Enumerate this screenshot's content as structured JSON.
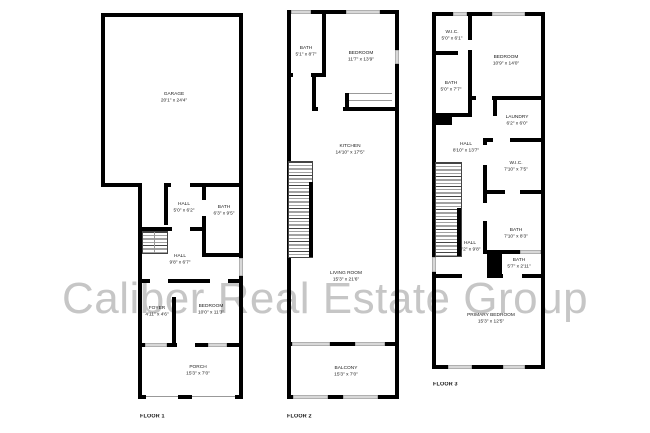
{
  "watermark": {
    "text": "Caliber Real Estate Group"
  },
  "colors": {
    "wall": "#000000",
    "window": "#d8d8d8",
    "watermark": "#c6c6c6"
  },
  "floors": [
    {
      "label": "FLOOR 1",
      "rooms": [
        {
          "name": "GARAGE",
          "dims": "20'1\" x 24'4\""
        },
        {
          "name": "HALL",
          "dims": "5'0\" x 6'2\""
        },
        {
          "name": "BATH",
          "dims": "6'3\" x 9'5\""
        },
        {
          "name": "HALL",
          "dims": "9'8\" x 6'7\""
        },
        {
          "name": "FOYER",
          "dims": "4'11\" x 4'6\""
        },
        {
          "name": "BEDROOM",
          "dims": "10'0\" x 11'3\""
        },
        {
          "name": "PORCH",
          "dims": "15'3\" x 7'0\""
        }
      ]
    },
    {
      "label": "FLOOR 2",
      "rooms": [
        {
          "name": "BATH",
          "dims": "5'1\" x 8'7\""
        },
        {
          "name": "BEDROOM",
          "dims": "11'7\" x 13'9\""
        },
        {
          "name": "KITCHEN",
          "dims": "14'10\" x 17'5\""
        },
        {
          "name": "LIVING ROOM",
          "dims": "15'3\" x 21'6\""
        },
        {
          "name": "BALCONY",
          "dims": "15'3\" x 7'0\""
        }
      ]
    },
    {
      "label": "FLOOR 3",
      "rooms": [
        {
          "name": "W.I.C.",
          "dims": "5'0\" x 6'1\""
        },
        {
          "name": "BEDROOM",
          "dims": "10'9\" x 14'0\""
        },
        {
          "name": "BATH",
          "dims": "5'0\" x 7'7\""
        },
        {
          "name": "LAUNDRY",
          "dims": "6'2\" x 6'0\""
        },
        {
          "name": "HALL",
          "dims": "8'10\" x 13'7\""
        },
        {
          "name": "W.I.C.",
          "dims": "7'10\" x 7'5\""
        },
        {
          "name": "BATH",
          "dims": "7'10\" x 8'3\""
        },
        {
          "name": "HALL",
          "dims": "4'2\" x 9'8\""
        },
        {
          "name": "BATH",
          "dims": "5'7\" x 2'11\""
        },
        {
          "name": "PRIMARY BEDROOM",
          "dims": "15'3\" x 12'5\""
        }
      ]
    }
  ]
}
